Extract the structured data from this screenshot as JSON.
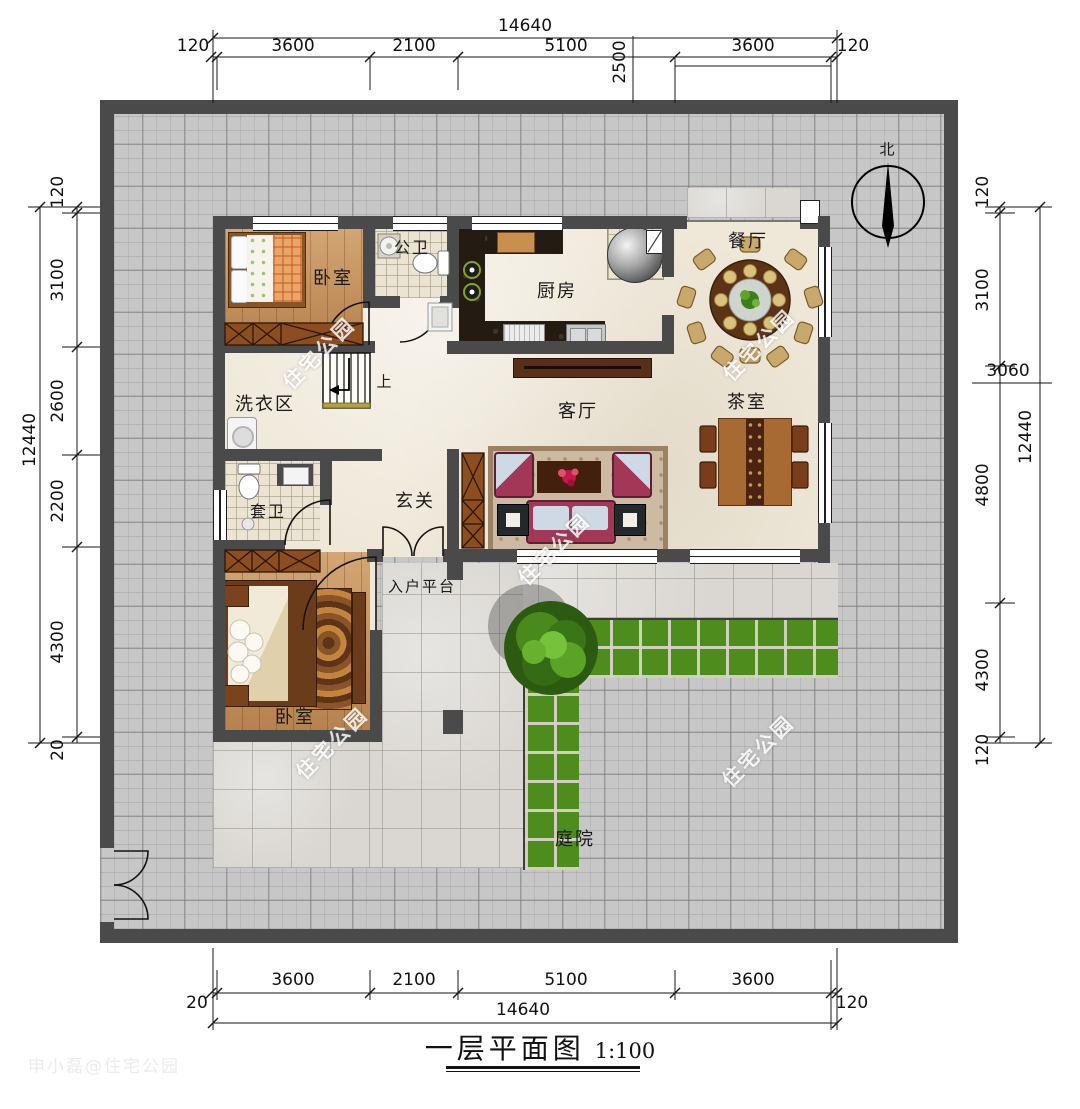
{
  "title": {
    "text": "一层平面图",
    "scale": "1:100"
  },
  "compass": {
    "north": "北"
  },
  "stairs": {
    "up": "上"
  },
  "watermark": {
    "text": "住宅公园",
    "credit": "申小磊@住宅公园"
  },
  "rooms": {
    "bedroom_top": "卧室",
    "bath_public": "公卫",
    "kitchen": "厨房",
    "dining": "餐厅",
    "tea": "茶室",
    "living": "客厅",
    "laundry": "洗衣区",
    "bath_ensuite": "套卫",
    "foyer": "玄关",
    "entry_platform": "入户平台",
    "bedroom_bottom": "卧室",
    "courtyard": "庭院"
  },
  "dims": {
    "top_total": "14640",
    "top_segments": [
      "120",
      "3600",
      "2100",
      "5100",
      "3600",
      "120"
    ],
    "top_vertical": "2500",
    "left_total": "12440",
    "left_segments": [
      "120",
      "3100",
      "2600",
      "2200",
      "4300",
      "20"
    ],
    "right_segments": [
      "120",
      "3100",
      "4800",
      "4300",
      "120"
    ],
    "right_extra": "3060",
    "right_total": "12440",
    "bottom_segments": [
      "3600",
      "2100",
      "5100",
      "3600"
    ],
    "bottom_total": "14640",
    "bottom_left": "20",
    "bottom_right": "120"
  },
  "colors": {
    "wall": "#4a4a4a",
    "lawn": "#4e8c1d",
    "wood_floor": "#c4905a",
    "courtyard_brick": "#c7c7c7",
    "marble": "#dad7d2"
  }
}
